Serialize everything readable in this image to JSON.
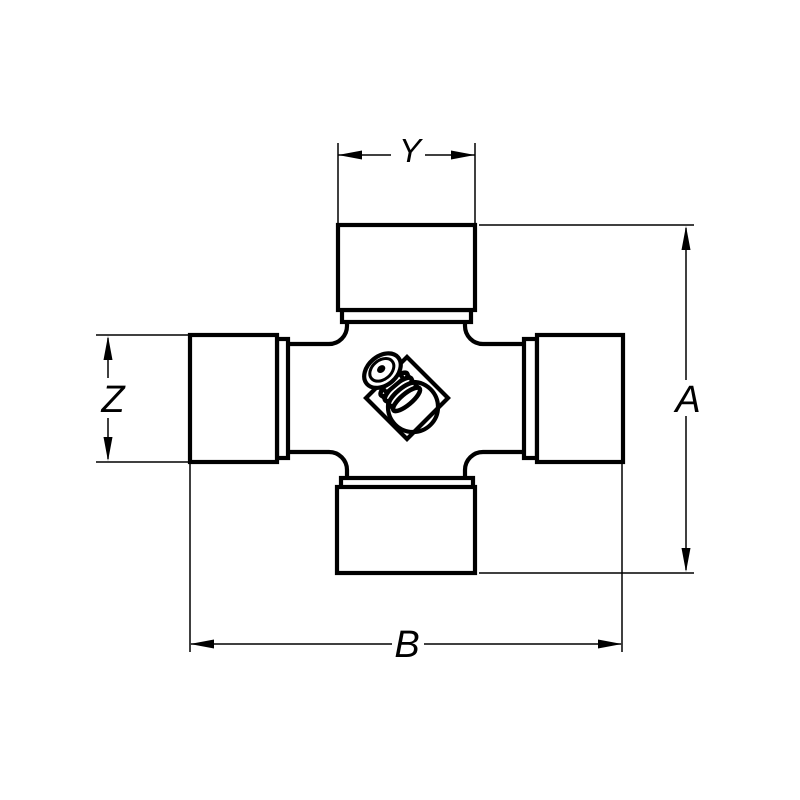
{
  "drawing": {
    "subject": "universal-joint-cross",
    "style": "technical-dimension-drawing",
    "background_color": "#ffffff",
    "line_color": "#000000",
    "center_feature": "grease-fitting-icon",
    "dimensions": {
      "top_width": {
        "label": "Y"
      },
      "right_height": {
        "label": "A"
      },
      "left_cup_height": {
        "label": "Z"
      },
      "bottom_width": {
        "label": "B"
      }
    }
  }
}
